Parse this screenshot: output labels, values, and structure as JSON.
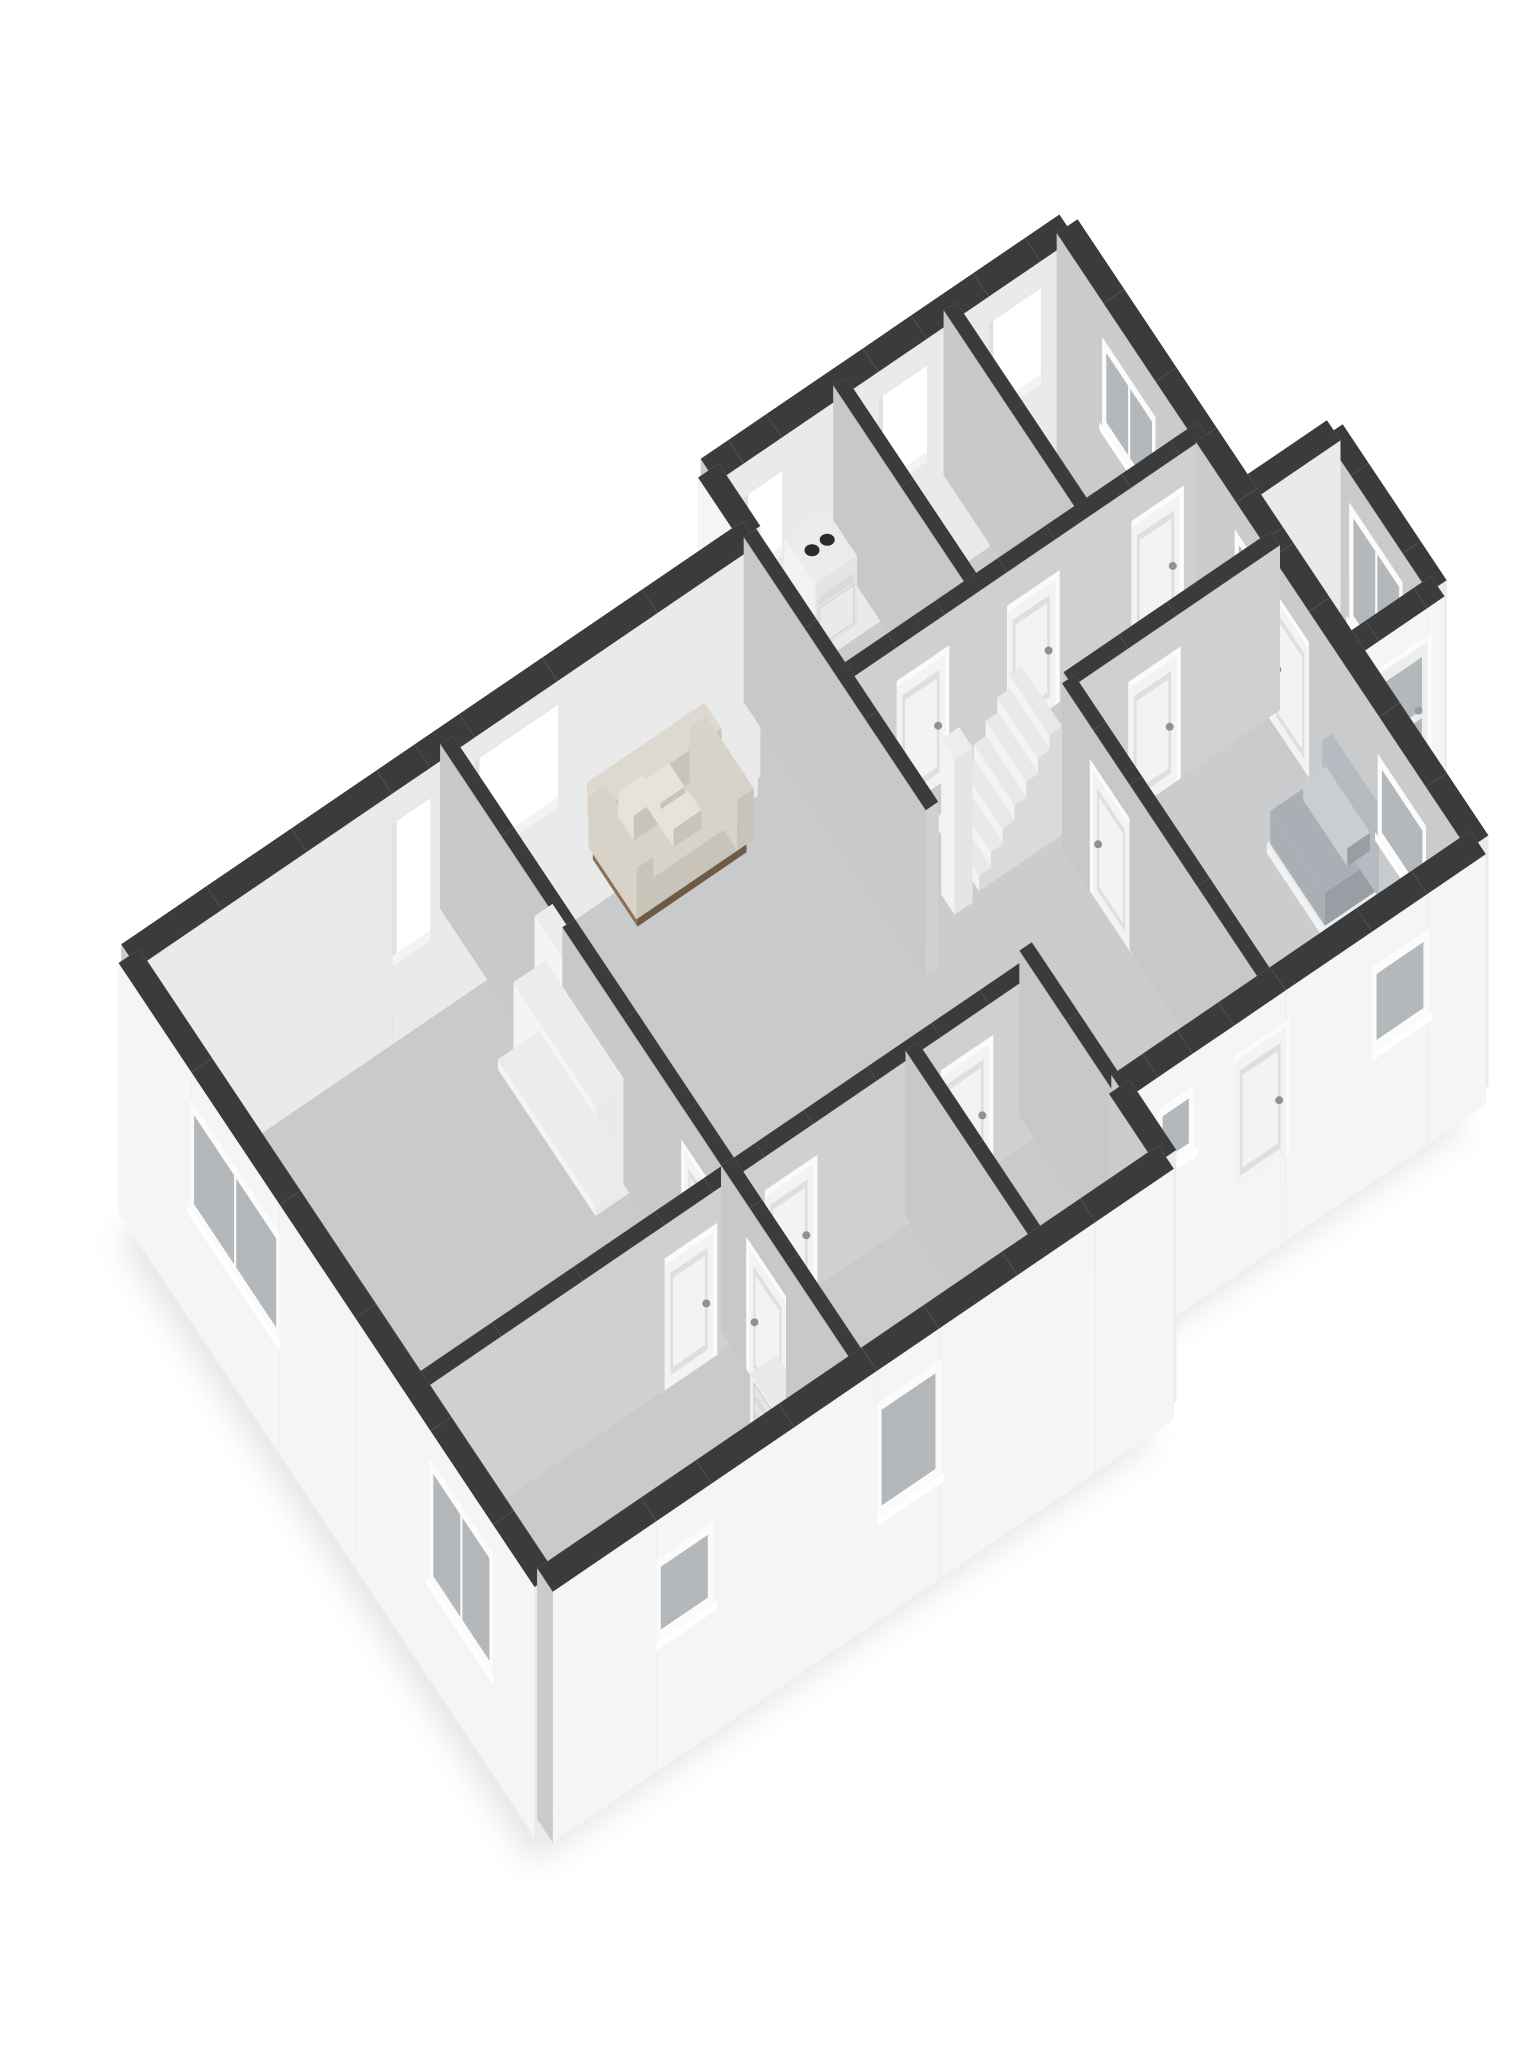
{
  "meta": {
    "description": "3D isometric render of a single-storey floor plan: white cut-away walls with dark charcoal wall tops, grey floors, a fireplace with burning fire, cream sofa, two grey beds, staircase with newel pillar, boiler appliance, dresser, and many white doors and windows.",
    "visible_text": []
  },
  "palette": {
    "background": "#ffffff",
    "wallTop": "#3a3b3d",
    "extFace": "#f5f5f6",
    "extInnerSE": "#e9ebeb",
    "extInnerSW": "#c9cbcc",
    "intFaceSE": "#cfd1d1",
    "intFaceSW": "#c6c8c9",
    "intBack": "#c0c2c3",
    "capFace": "#dfe1e2",
    "floorA": "#c9cacb",
    "floorB": "#cbcccd",
    "floorVest": "#c5c6c7",
    "frame": "#fbfbfc",
    "glass": "#b4b8ba",
    "door": "#f3f3f4",
    "doorPanel": "#dddfe0",
    "handle": "#8f9295",
    "shadow": "#cfcfcf",
    "fireDark": "#1b130c",
    "fireOuter": "#c2601c",
    "fireMid": "#f0a83c",
    "fireCore": "#f8d272",
    "log": "#2f2013",
    "sofaSeat": "#d7d3c9",
    "sofaShade": "#c8c4ba",
    "sofaBack": "#ded9d0",
    "sofaPillow": "#e7e3da",
    "sofaWood": "#8b7156",
    "sofaWoodDark": "#6f5a44",
    "bedDarkTop": "#7c828c",
    "bedDarkSide": "#696f77",
    "bedLightTop": "#a9afb4",
    "bedLightSide": "#989ea3",
    "headboard": "#b5bbc0",
    "pillow": "#c9ced3",
    "white": "#f2f2f3"
  },
  "scene": {
    "projection": {
      "ux": 69,
      "uy": -47,
      "vx": -52,
      "vy": -78,
      "ox": 545,
      "oy": 1745,
      "wallHeight": 165
    },
    "extBase": -0.52,
    "shadow": {
      "dx": -12,
      "dy": 34,
      "blur": 15,
      "opacity": 0.5
    },
    "footprint": [
      [
        0,
        0
      ],
      [
        9,
        0
      ],
      [
        9,
        0.9
      ],
      [
        14.2,
        0.9
      ],
      [
        14.2,
        3.4
      ],
      [
        15.5,
        3.4
      ],
      [
        15.5,
        5.4
      ],
      [
        14.2,
        5.4
      ],
      [
        14.2,
        8.8
      ],
      [
        9,
        8.8
      ],
      [
        9,
        8.0
      ],
      [
        0,
        8.0
      ]
    ],
    "floors": [
      {
        "id": "floor-main",
        "fill": "floorA",
        "poly": [
          [
            0,
            0
          ],
          [
            9,
            0
          ],
          [
            9,
            8
          ],
          [
            0,
            8
          ]
        ]
      },
      {
        "id": "floor-wing",
        "fill": "floorB",
        "poly": [
          [
            9,
            0.9
          ],
          [
            14.2,
            0.9
          ],
          [
            14.2,
            8.8
          ],
          [
            9,
            8.8
          ]
        ]
      },
      {
        "id": "floor-vestibule",
        "fill": "floorVest",
        "poly": [
          [
            14.2,
            3.4
          ],
          [
            15.5,
            3.4
          ],
          [
            15.5,
            5.4
          ],
          [
            14.2,
            5.4
          ]
        ]
      }
    ],
    "walls": [
      {
        "id": "sw-facade",
        "kind": "ext",
        "t": 0.3,
        "out": 1,
        "a": [
          0,
          0
        ],
        "b": [
          0,
          8
        ],
        "openings": [
          {
            "style": "window",
            "from": 0.8,
            "to": 2.0,
            "z0": 0.12,
            "z1": 0.8
          },
          {
            "style": "window",
            "from": 4.9,
            "to": 6.6,
            "z0": 0.2,
            "z1": 0.8
          }
        ]
      },
      {
        "id": "nw-facade-a",
        "kind": "ext",
        "t": 0.3,
        "out": 1,
        "a": [
          0,
          8
        ],
        "b": [
          9,
          8
        ],
        "openings": [
          {
            "style": "openwin",
            "from": 3.7,
            "to": 4.25,
            "z0": 0.02,
            "z1": 0.82
          },
          {
            "style": "openwin",
            "from": 4.9,
            "to": 6.1,
            "z0": 0.3,
            "z1": 0.86
          }
        ]
      },
      {
        "id": "se-facade-a",
        "kind": "ext",
        "t": 0.3,
        "out": -1,
        "a": [
          0,
          0
        ],
        "b": [
          9,
          0
        ],
        "openings": [
          {
            "style": "window",
            "from": 1.5,
            "to": 2.3,
            "z0": 0.3,
            "z1": 0.74
          },
          {
            "style": "window",
            "from": 4.7,
            "to": 5.6,
            "z0": 0.14,
            "z1": 0.78
          }
        ]
      },
      {
        "id": "se-step",
        "kind": "ext",
        "t": 0.3,
        "out": -1,
        "a": [
          9,
          0
        ],
        "b": [
          9,
          0.9
        ]
      },
      {
        "id": "se-facade-b",
        "kind": "ext",
        "t": 0.3,
        "out": -1,
        "a": [
          9,
          0.9
        ],
        "b": [
          14.2,
          0.9
        ],
        "openings": [
          {
            "style": "window",
            "from": 0.45,
            "to": 0.95,
            "z0": 0.45,
            "z1": 0.78
          },
          {
            "style": "door",
            "from": 1.55,
            "to": 2.3,
            "z0": 0,
            "z1": 0.78
          },
          {
            "style": "window",
            "from": 3.55,
            "to": 4.35,
            "z0": 0.3,
            "z1": 0.76
          }
        ]
      },
      {
        "id": "ne-wall",
        "kind": "ext",
        "t": 0.3,
        "out": -1,
        "a": [
          14.2,
          0.9
        ],
        "b": [
          14.2,
          8.8
        ],
        "openings": [
          {
            "style": "window",
            "from": 0.8,
            "to": 1.7,
            "z0": 0.3,
            "z1": 0.74
          },
          {
            "style": "door",
            "from": 3.05,
            "to": 3.75,
            "z0": 0,
            "z1": 0.78
          },
          {
            "style": "window",
            "from": 3.95,
            "to": 4.45,
            "z0": 0.2,
            "z1": 0.8
          },
          {
            "style": "window",
            "from": 6.0,
            "to": 7.0,
            "z0": 0.28,
            "z1": 0.76
          }
        ]
      },
      {
        "id": "nw-facade-b",
        "kind": "ext",
        "t": 0.3,
        "out": 1,
        "a": [
          9,
          8.8
        ],
        "b": [
          14.2,
          8.8
        ],
        "openings": [
          {
            "style": "openwin",
            "from": 0.4,
            "to": 0.95,
            "z0": 0.35,
            "z1": 0.8
          },
          {
            "style": "openwin",
            "from": 2.35,
            "to": 3.05,
            "z0": 0.32,
            "z1": 0.84
          },
          {
            "style": "openwin",
            "from": 3.95,
            "to": 4.7,
            "z0": 0.32,
            "z1": 0.84
          }
        ]
      },
      {
        "id": "nw-step",
        "kind": "ext",
        "t": 0.3,
        "out": 1,
        "a": [
          9,
          8
        ],
        "b": [
          9,
          8.8
        ]
      },
      {
        "id": "vest-se",
        "kind": "ext",
        "t": 0.26,
        "out": -1,
        "a": [
          14.2,
          3.4
        ],
        "b": [
          15.5,
          3.4
        ],
        "openings": [
          {
            "style": "glassdoor",
            "from": 0.35,
            "to": 1.05,
            "z0": 0,
            "z1": 0.8
          }
        ]
      },
      {
        "id": "vest-ne",
        "kind": "ext",
        "t": 0.26,
        "out": -1,
        "a": [
          15.5,
          3.4
        ],
        "b": [
          15.5,
          5.4
        ],
        "openings": [
          {
            "style": "window",
            "from": 0.5,
            "to": 1.5,
            "z0": 0.15,
            "z1": 0.8
          }
        ]
      },
      {
        "id": "vest-nw",
        "kind": "ext",
        "t": 0.26,
        "out": 1,
        "a": [
          14.2,
          5.4
        ],
        "b": [
          15.5,
          5.4
        ]
      },
      {
        "id": "wall-living-div",
        "kind": "int",
        "t": 0.18,
        "a": [
          4.6,
          0
        ],
        "b": [
          4.6,
          8
        ],
        "openings": [
          {
            "style": "door",
            "from": 1.35,
            "to": 2.05,
            "z0": 0,
            "z1": 0.76
          },
          {
            "style": "door",
            "from": 2.6,
            "to": 3.3,
            "z0": 0,
            "z1": 0.76
          }
        ]
      },
      {
        "id": "wall-bed1",
        "kind": "int",
        "t": 0.18,
        "a": [
          0,
          2.5
        ],
        "b": [
          4.6,
          2.5
        ],
        "openings": [
          {
            "style": "door",
            "from": 3.55,
            "to": 4.25,
            "z0": 0,
            "z1": 0.76
          }
        ]
      },
      {
        "id": "wall-a-mid",
        "kind": "int",
        "t": 0.18,
        "a": [
          4.6,
          2.5
        ],
        "b": [
          9,
          2.5
        ],
        "openings": [
          {
            "style": "door",
            "from": 0.4,
            "to": 1.1,
            "z0": 0,
            "z1": 0.76
          },
          {
            "style": "door",
            "from": 2.95,
            "to": 3.65,
            "z0": 0,
            "z1": 0.76
          }
        ]
      },
      {
        "id": "wall-bath",
        "kind": "int",
        "t": 0.18,
        "a": [
          7.2,
          0
        ],
        "b": [
          7.2,
          2.5
        ]
      },
      {
        "id": "wall-spine-s",
        "kind": "int",
        "t": 0.18,
        "a": [
          9,
          0.9
        ],
        "b": [
          9,
          2.7
        ]
      },
      {
        "id": "wall-spine-n",
        "kind": "int",
        "t": 0.18,
        "a": [
          9,
          4.5
        ],
        "b": [
          9,
          8
        ]
      },
      {
        "id": "wall-bed3",
        "kind": "int",
        "t": 0.18,
        "a": [
          11.2,
          0.9
        ],
        "b": [
          11.2,
          4.8
        ],
        "openings": [
          {
            "style": "door",
            "from": 2.6,
            "to": 3.3,
            "z0": 0,
            "z1": 0.76
          }
        ]
      },
      {
        "id": "wall-bed3-n",
        "kind": "int",
        "t": 0.18,
        "a": [
          11.2,
          4.8
        ],
        "b": [
          14.2,
          4.8
        ],
        "openings": [
          {
            "style": "door",
            "from": 0.8,
            "to": 1.5,
            "z0": 0,
            "z1": 0.76
          }
        ]
      },
      {
        "id": "wall-top-rooms",
        "kind": "int",
        "t": 0.18,
        "a": [
          9,
          6.2
        ],
        "b": [
          14.2,
          6.2
        ],
        "openings": [
          {
            "style": "door",
            "from": 0.7,
            "to": 1.4,
            "z0": 0,
            "z1": 0.76
          },
          {
            "style": "door",
            "from": 2.3,
            "to": 3.0,
            "z0": 0,
            "z1": 0.76
          },
          {
            "style": "door",
            "from": 4.1,
            "to": 4.8,
            "z0": 0,
            "z1": 0.76
          }
        ]
      },
      {
        "id": "wall-top-div1",
        "kind": "int",
        "t": 0.18,
        "a": [
          10.9,
          6.2
        ],
        "b": [
          10.9,
          8.8
        ]
      },
      {
        "id": "wall-top-div2",
        "kind": "int",
        "t": 0.18,
        "a": [
          12.5,
          6.2
        ],
        "b": [
          12.5,
          8.8
        ]
      }
    ],
    "furniture": [
      {
        "type": "fireplace",
        "id": "fireplace",
        "base": [
          4.02,
          4.36,
          4.62,
          6.24,
          0,
          0.06
        ],
        "lower": [
          4.14,
          4.5,
          4.6,
          6.1,
          0,
          0.56
        ],
        "upper": [
          4.34,
          4.64,
          4.6,
          5.96,
          0.56,
          0.97
        ],
        "opening": {
          "v0": 5.02,
          "v1": 5.6,
          "z0": 0.09,
          "z1": 0.45
        }
      },
      {
        "type": "sofa",
        "id": "sofa",
        "u0": 6.3,
        "v0": 6.6,
        "u1": 8.0,
        "v1": 7.55
      },
      {
        "type": "dresser",
        "id": "dresser",
        "u0": 4.14,
        "v0": 0.55,
        "u1": 4.52,
        "v1": 1.55,
        "h": 0.34
      },
      {
        "type": "bed",
        "id": "bed-dark",
        "variant": "dark",
        "u0": 12.2,
        "v0": 1.23,
        "u1": 13.3,
        "v1": 2.15,
        "h": 0.24
      },
      {
        "type": "bed",
        "id": "bed-light",
        "variant": "light",
        "u0": 13.15,
        "v0": 2.45,
        "u1": 14.0,
        "v1": 3.5,
        "h": 0.26,
        "headboard": true,
        "pillow": true
      },
      {
        "type": "appliance",
        "id": "boiler",
        "u0": 9.95,
        "v0": 8.0,
        "u1": 10.55,
        "v1": 8.6,
        "h": 0.42
      },
      {
        "type": "stairs",
        "id": "staircase",
        "u0": 10.0,
        "v0": 4.92,
        "v1": 5.7,
        "stepDepth": 0.17,
        "steps": 7,
        "rise": 0.094
      },
      {
        "type": "box",
        "id": "stair-pillar",
        "u0": 9.6,
        "v0": 4.86,
        "u1": 9.86,
        "v1": 5.12,
        "z0": 0,
        "z1": 0.94,
        "cols": {
          "top": "#ededee",
          "sw": "#f3f3f4",
          "se": "#e4e5e6"
        }
      }
    ]
  }
}
